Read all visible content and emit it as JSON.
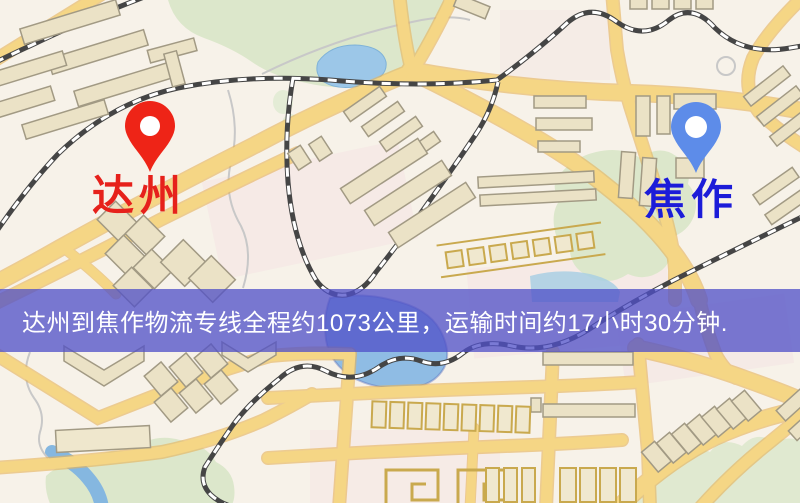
{
  "markers": {
    "origin": {
      "label": "达州",
      "icon": "red-location-pin",
      "color": "#ee2417",
      "label_color": "#e6211b"
    },
    "destination": {
      "label": "焦作",
      "icon": "blue-location-pin",
      "color": "#5d8ce9",
      "label_color": "#1c1cd8"
    }
  },
  "banner": {
    "text": "达州到焦作物流专线全程约1073公里，运输时间约17小时30分钟.",
    "route": "达州到焦作物流专线",
    "distance": "约1073公里",
    "duration": "约17小时30分钟",
    "background_color": "#5252c8",
    "text_color": "#ffffff"
  },
  "map": {
    "type": "street-map",
    "colors": {
      "land": "#f7f2e9",
      "park": "#dce7cb",
      "water": "#9cc7e8",
      "road": "#f5d685",
      "road_casing": "#e6b258",
      "railway": "#454545",
      "building": "#ebe2c6"
    }
  }
}
